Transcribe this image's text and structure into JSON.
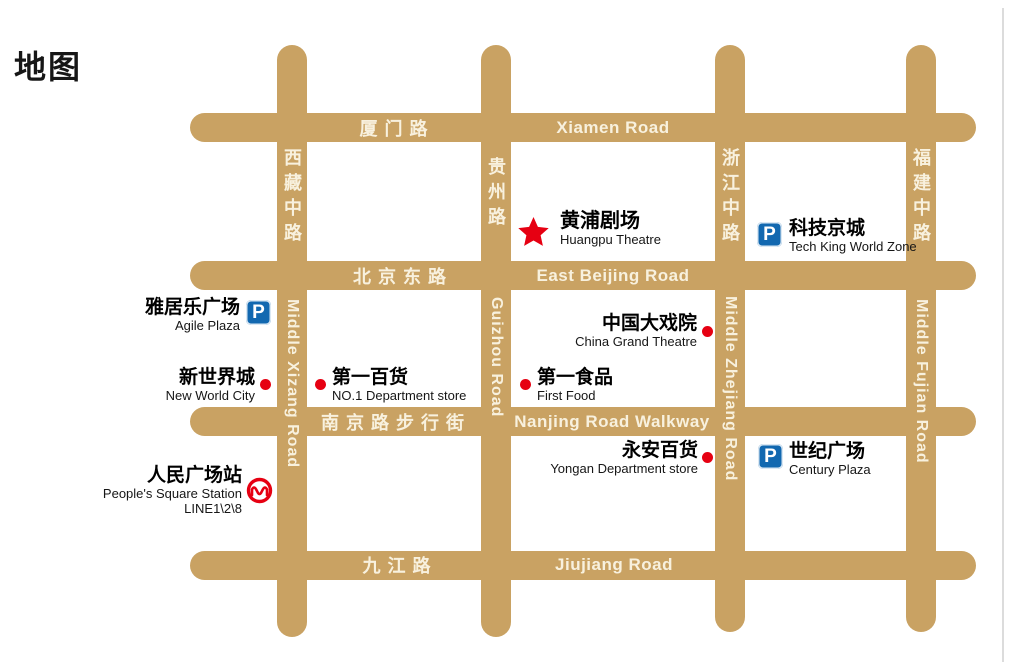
{
  "page": {
    "title": "地图"
  },
  "colors": {
    "road": "#C9A263",
    "road_label": "#F8F1DE",
    "poi_red": "#E60012",
    "parking_blue": "#1268B0",
    "metro_red": "#E60012"
  },
  "roads": {
    "horizontal": [
      {
        "name_zh": "厦门路",
        "name_en": "Xiamen Road"
      },
      {
        "name_zh": "北京东路",
        "name_en": "East Beijing Road"
      },
      {
        "name_zh": "南京路步行街",
        "name_en": "Nanjing Road Walkway"
      },
      {
        "name_zh": "九江路",
        "name_en": "Jiujiang Road"
      }
    ],
    "vertical": [
      {
        "name_zh": "西藏中路",
        "name_en": "Middle Xizang Road"
      },
      {
        "name_zh": "贵州路",
        "name_en": "Guizhou Road"
      },
      {
        "name_zh": "浙江中路",
        "name_en": "Middle Zhejiang Road"
      },
      {
        "name_zh": "福建中路",
        "name_en": "Middle Fujian Road"
      }
    ]
  },
  "pois": [
    {
      "name_zh": "黄浦剧场",
      "name_en": "Huangpu Theatre",
      "marker": "star-icon"
    },
    {
      "name_zh": "科技京城",
      "name_en": "Tech King World Zone",
      "marker": "parking-icon"
    },
    {
      "name_zh": "雅居乐广场",
      "name_en": "Agile Plaza",
      "marker": "parking-icon"
    },
    {
      "name_zh": "中国大戏院",
      "name_en": "China Grand Theatre",
      "marker": "dot"
    },
    {
      "name_zh": "新世界城",
      "name_en": "New World City",
      "marker": "dot"
    },
    {
      "name_zh": "第一百货",
      "name_en": "NO.1 Department store",
      "marker": "dot"
    },
    {
      "name_zh": "第一食品",
      "name_en": "First Food",
      "marker": "dot"
    },
    {
      "name_zh": "永安百货",
      "name_en": "Yongan Department store",
      "marker": "dot"
    },
    {
      "name_zh": "世纪广场",
      "name_en": "Century Plaza",
      "marker": "parking-icon"
    },
    {
      "name_zh": "人民广场站",
      "name_en": "People's Square Station",
      "line_label": "LINE1\\2\\8",
      "marker": "metro-icon"
    }
  ],
  "icons": {
    "parking_label": "P"
  }
}
